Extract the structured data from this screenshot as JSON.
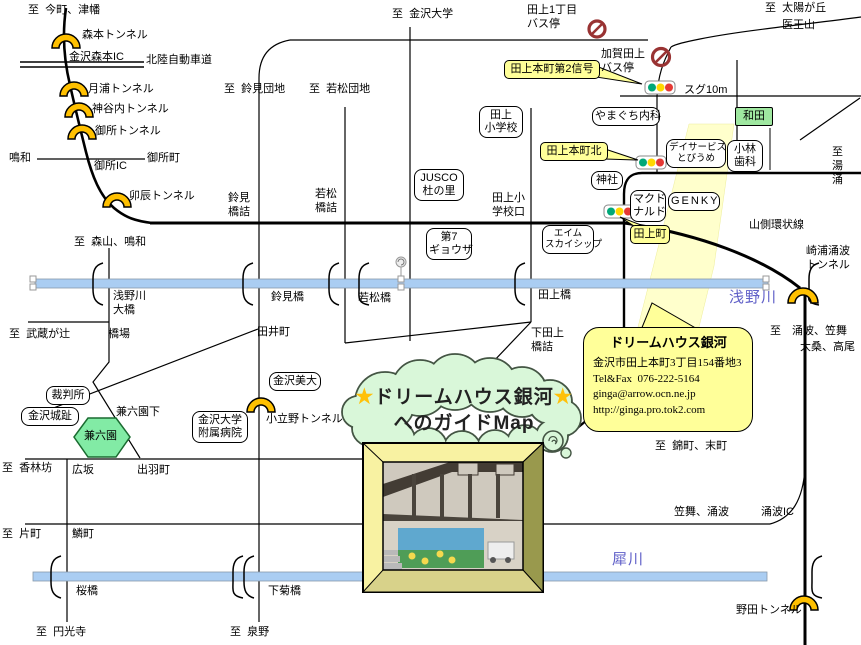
{
  "t": {
    "imamachi": "至  今町、津幡",
    "morimoto_t": "森本トンネル",
    "morimoto_ic": "金沢森本IC",
    "hokuriku": "北陸自動車道",
    "tsukiura": "月浦トンネル",
    "kamiyachi": "神谷内トンネル",
    "gosho_t": "御所トンネル",
    "naruwa": "鳴和",
    "goshomachi": "御所町",
    "gosho_ic": "御所IC",
    "udatsu": "卯辰トンネル",
    "suzumi_danchi": "至  鈴見団地",
    "suzumi_hashizume": "鈴見\n橋詰",
    "wakamatsu_hashizume": "若松\n橋詰",
    "wakamatsu_danchi": "至  若松団地",
    "kanazawa_univ": "至  金沢大学",
    "tagami1": "田上1丁目\nバス停",
    "taiyogaoka": "至  太陽が丘",
    "iozen": "医王山",
    "kagatagami": "加賀田上\nバス停",
    "signal2": "田上本町第2信号",
    "sugu": "スグ10m",
    "wada": "和田",
    "yamaguchi": "やまぐち内科",
    "dayservice": "デイサービス\nとびうめ",
    "kobayashi": "小林\n歯科",
    "yuwaku": "至\n湯\n涌",
    "kita": "田上本町北",
    "jinja": "神社",
    "mcdonalds": "マクド\nナルド",
    "genky": "GENKY",
    "tagamimachi": "田上町",
    "yamagawa": "山側環状線",
    "sakiura": "崎浦涌波\nトンネル",
    "tagami_es": "田上\n小学校",
    "jusco": "JUSCO\n杜の里",
    "tagami_es_guchi": "田上小\n学校口",
    "gyoza": "第7\nギョウザ",
    "aim": "エイム\nスカイシップ",
    "moriyama": "至  森山、鳴和",
    "asanogawa_ohashi": "浅野川\n大橋",
    "suzumibashi": "鈴見橋",
    "wakamatsubashi": "若松橋",
    "tagamibashi": "田上橋",
    "asanogawa": "浅野川",
    "musashi": "至  武蔵が辻",
    "hashiba": "橋場",
    "taimachi": "田井町",
    "shimotagami": "下田上\n橋詰",
    "wakunami_kasamai": "至　涌波、笠舞",
    "okuwa_takao": "大桑、高尾",
    "court": "裁判所",
    "castle": "金沢城趾",
    "kenrokuen_shita": "兼六園下",
    "kenrokuen": "兼六園",
    "univ_hosp": "金沢大学\n附属病院",
    "bidai": "金沢美大",
    "kodatsuno": "小立野トンネル",
    "korinbo": "至  香林坊",
    "hirosaka": "広坂",
    "dewamachi": "出羽町",
    "nishikimachi": "至  錦町、末町",
    "katamachi": "至  片町",
    "urokomachi": "鱗町",
    "kasamai_wakunami": "笠舞、涌波",
    "wakunami_ic": "涌波IC",
    "sakurabashi": "桜橋",
    "shimokikubashi": "下菊橋",
    "saigawa": "犀川",
    "enkoji": "至  円光寺",
    "izumino": "至  泉野",
    "noda": "野田トンネル"
  },
  "cloud": {
    "star": "★",
    "line1": "ドリームハウス銀河",
    "line2": "へのガイドMap"
  },
  "info": {
    "title": "ドリームハウス銀河",
    "address": "金沢市田上本町3丁目154番地3",
    "tel": "Tel&Fax  076-222-5164",
    "mail": "ginga@arrow.ocn.ne.jp",
    "url": "http://ginga.pro.tok2.com"
  },
  "colors": {
    "river": "#AACDF2",
    "callout_yellow": "#FFFF99",
    "highlight_road": "#FFFFCC",
    "landmark_green": "#9FE7A0",
    "park_green": "#82EBA5",
    "tunnel_orange": "#FFC000",
    "river_label": "#6060C8"
  }
}
